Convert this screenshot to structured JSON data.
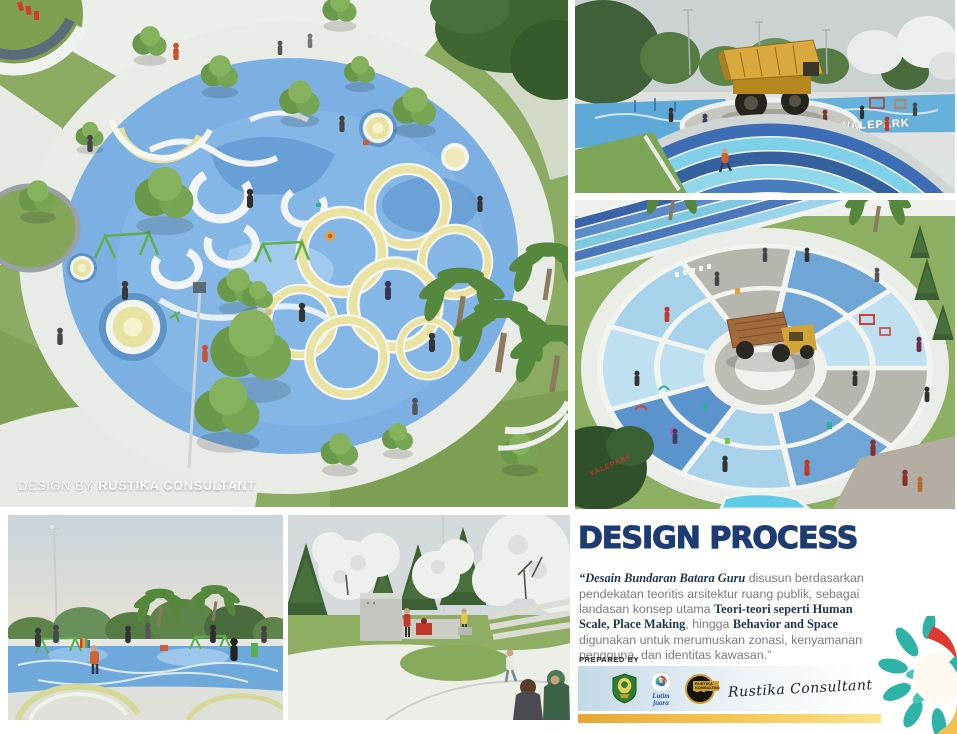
{
  "credit": {
    "prefix": "DESIGN BY",
    "name": "RUSTIKA CONSULTANT"
  },
  "signs": {
    "top_right": "VALEPARK",
    "mid_right": "VALEPARK"
  },
  "design_process": {
    "heading": "DESIGN PROCESS",
    "paragraph": {
      "quote_open": "“Desain Bundaran Batara Guru",
      "seg1": " disusun berdasarkan pendekatan teoritis arsitektur ruang publik, sebagai landasan konsep utama ",
      "bold1": "Teori-teori seperti Human Scale, Place Making",
      "seg2": ", hingga ",
      "bold2": "Behavior and Space",
      "seg3": " digunakan untuk merumuskan zonasi, kenyamanan pengguna, dan identitas kawasan.”"
    },
    "prepared_by": "PREPARED BY",
    "logos": {
      "regency_seal": "luwu-timur-regency-seal",
      "lutim_caption_1": "Lutim",
      "lutim_caption_2": "juara",
      "monogram_letter": "R",
      "monogram_caption": "RUSTIKA KONSULTAN",
      "signature": "Rustika Consultant"
    }
  },
  "colors": {
    "heading_navy": "#1e3c74",
    "body_gray": "#7b7b7b",
    "accent_teal": "#2fb3a8",
    "accent_red": "#e0392f",
    "gold_bar": "#e8a732",
    "track_blue_dark": "#3a6ab2",
    "track_blue_light": "#7fd0e8",
    "playground_blue": "#7cb0e2",
    "ring_yellow": "#e9e2a0",
    "grass_green": "#8aab61"
  }
}
